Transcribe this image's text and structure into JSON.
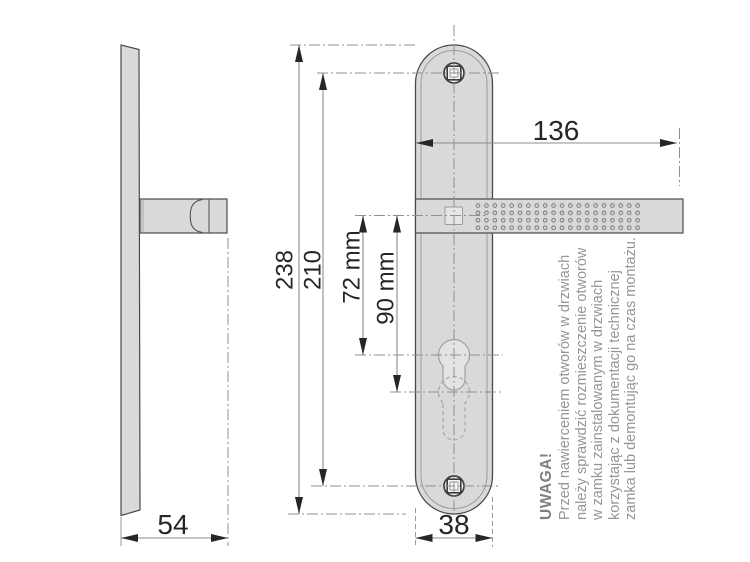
{
  "drawing": {
    "kind": "door-handle-backplate-dimension-drawing",
    "dimensions": {
      "plate_total_height": "238",
      "screw_hole_spacing": "210",
      "handle_axis_to_keyhole": "72 mm",
      "handle_axis_to_keyhole_alt": "90 mm",
      "handle_length": "136",
      "handle_projection": "54",
      "plate_width": "38"
    },
    "note": {
      "heading": "UWAGA!",
      "lines": [
        "Przed nawierceniem otworów w drzwiach",
        "należy sprawdzić rozmieszczenie otworów",
        "w zamku zainstalowanym w drzwiach",
        "korzystając z dokumentacji technicznej",
        "zamka lub demontując go na czas montażu."
      ]
    },
    "colors": {
      "part_fill": "#d9d9d9",
      "part_outline": "#4a4a4a",
      "thin_outline": "#9c9c9c",
      "dimension_line": "#8c8c8c",
      "arrowhead": "#262626",
      "centerline": "#909090",
      "dimension_text": "#262626",
      "note_text": "#959595"
    }
  }
}
